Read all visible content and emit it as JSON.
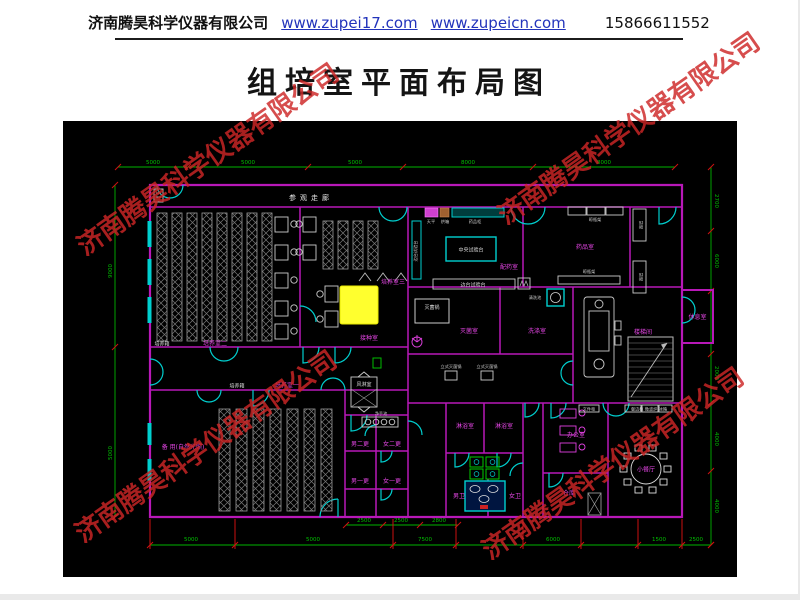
{
  "header": {
    "company": "济南腾昊科学仪器有限公司",
    "url1": "www.zupei17.com",
    "url2": "www.zupeicn.com",
    "phone": "15866611552"
  },
  "title": "组培室平面布局图",
  "watermark": "济南腾昊科学仪器有限公司",
  "plan": {
    "colors": {
      "wall": "#b818b8",
      "door_window": "#00cfcf",
      "dimension": "#00b400",
      "room_label": "#e646e6",
      "highlight": "#ffff2e",
      "watermark_red": "#cd2626"
    },
    "labels": {
      "corridor": "参观走廊",
      "room2": "培养室二",
      "room3": "培养室三",
      "room1": "培养室一",
      "incubator": "培养箱",
      "spare": "备 用(自然光照)",
      "inoculation": "接种室",
      "prep": "配药室",
      "central_bench": "中央试验台",
      "side_bench": "边台试验台",
      "balance": "天平",
      "oven": "烘箱",
      "med_cabinet": "药品柜",
      "med_room": "药品室",
      "dry_rack": "晾瓶架",
      "shelf": "货架",
      "steril_room": "灭菌室",
      "steril_pot": "灭菌锅",
      "autoclave": "立式灭菌锅",
      "wash_room": "洗涤室",
      "wash_sink": "清洗池",
      "rest": "休息室",
      "stairwell": "楼梯间",
      "air_shower": "风淋室",
      "hand_sink": "净手池",
      "m2": "男二更",
      "w2": "女二更",
      "m1": "男一更",
      "w1": "女一更",
      "shower": "淋浴室",
      "mt": "男卫",
      "wt": "女卫",
      "office": "办公室",
      "cabinet": "文件柜",
      "storage": "仓库",
      "dining": "小餐厅",
      "dining_cab": "餐边柜 微波炉 冰箱"
    },
    "dims": {
      "top": [
        "5000",
        "5000",
        "5000",
        "8000",
        "8000"
      ],
      "left": [
        "9000",
        "5000"
      ],
      "right": [
        "2700",
        "6000",
        "2000",
        "4000",
        "4000"
      ],
      "bottom": [
        "5000",
        "5000",
        "7500",
        "6000",
        "1500",
        "2500"
      ],
      "sub": [
        "2500",
        "2500",
        "2800"
      ]
    }
  }
}
